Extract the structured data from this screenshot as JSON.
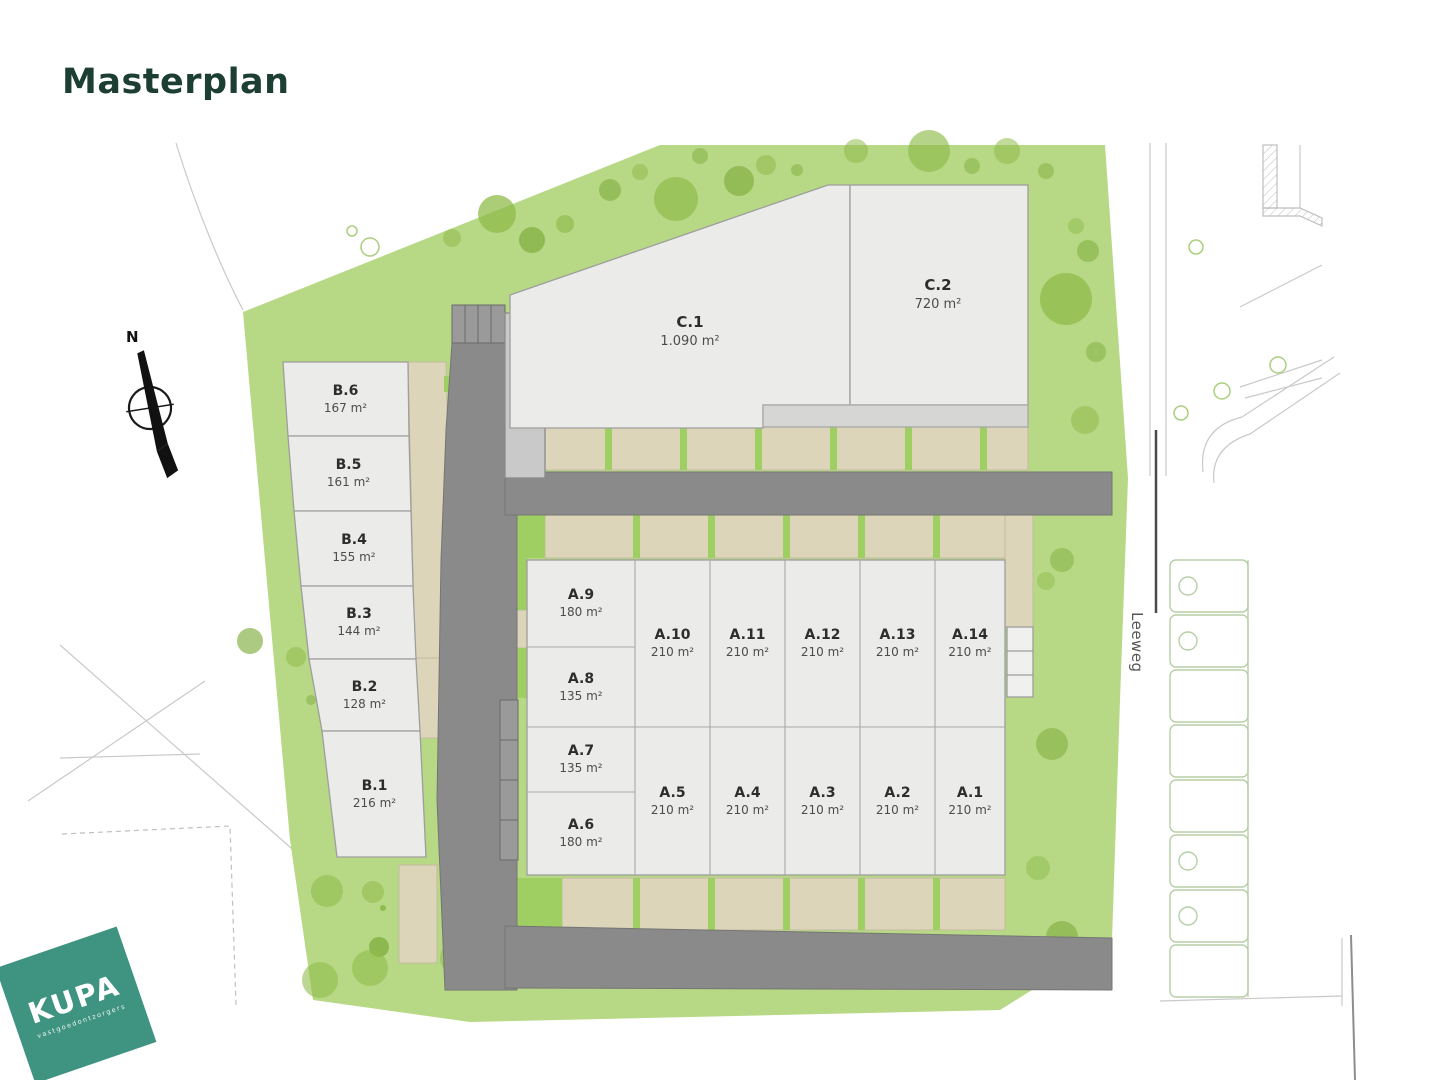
{
  "title": "Masterplan",
  "compass": {
    "label": "N"
  },
  "street": {
    "name": "Leeweg"
  },
  "logo": {
    "brand": "KUPA",
    "tagline": "vastgoedontzorgers"
  },
  "lots": {
    "b": [
      {
        "id": "B.6",
        "area": "167 m²"
      },
      {
        "id": "B.5",
        "area": "161 m²"
      },
      {
        "id": "B.4",
        "area": "155 m²"
      },
      {
        "id": "B.3",
        "area": "144 m²"
      },
      {
        "id": "B.2",
        "area": "128 m²"
      },
      {
        "id": "B.1",
        "area": "216 m²"
      }
    ],
    "c": [
      {
        "id": "C.1",
        "area": "1.090 m²"
      },
      {
        "id": "C.2",
        "area": "720 m²"
      }
    ],
    "a_col": [
      {
        "id": "A.9",
        "area": "180 m²"
      },
      {
        "id": "A.8",
        "area": "135 m²"
      },
      {
        "id": "A.7",
        "area": "135 m²"
      },
      {
        "id": "A.6",
        "area": "180 m²"
      }
    ],
    "a_top": [
      {
        "id": "A.10",
        "area": "210 m²"
      },
      {
        "id": "A.11",
        "area": "210 m²"
      },
      {
        "id": "A.12",
        "area": "210 m²"
      },
      {
        "id": "A.13",
        "area": "210 m²"
      },
      {
        "id": "A.14",
        "area": "210 m²"
      }
    ],
    "a_bottom": [
      {
        "id": "A.5",
        "area": "210 m²"
      },
      {
        "id": "A.4",
        "area": "210 m²"
      },
      {
        "id": "A.3",
        "area": "210 m²"
      },
      {
        "id": "A.2",
        "area": "210 m²"
      },
      {
        "id": "A.1",
        "area": "210 m²"
      }
    ]
  },
  "colors": {
    "title": "#1c3e33",
    "site_green": "#b7d884",
    "tree_dark": "#7fae3e",
    "tree_mid": "#8fbc4b",
    "road_gray": "#8a8a8a",
    "building_fill": "#ebebe9",
    "beige": "#dcd5b9",
    "divider_green": "#9fcf63",
    "logo_green": "#3e9381"
  }
}
